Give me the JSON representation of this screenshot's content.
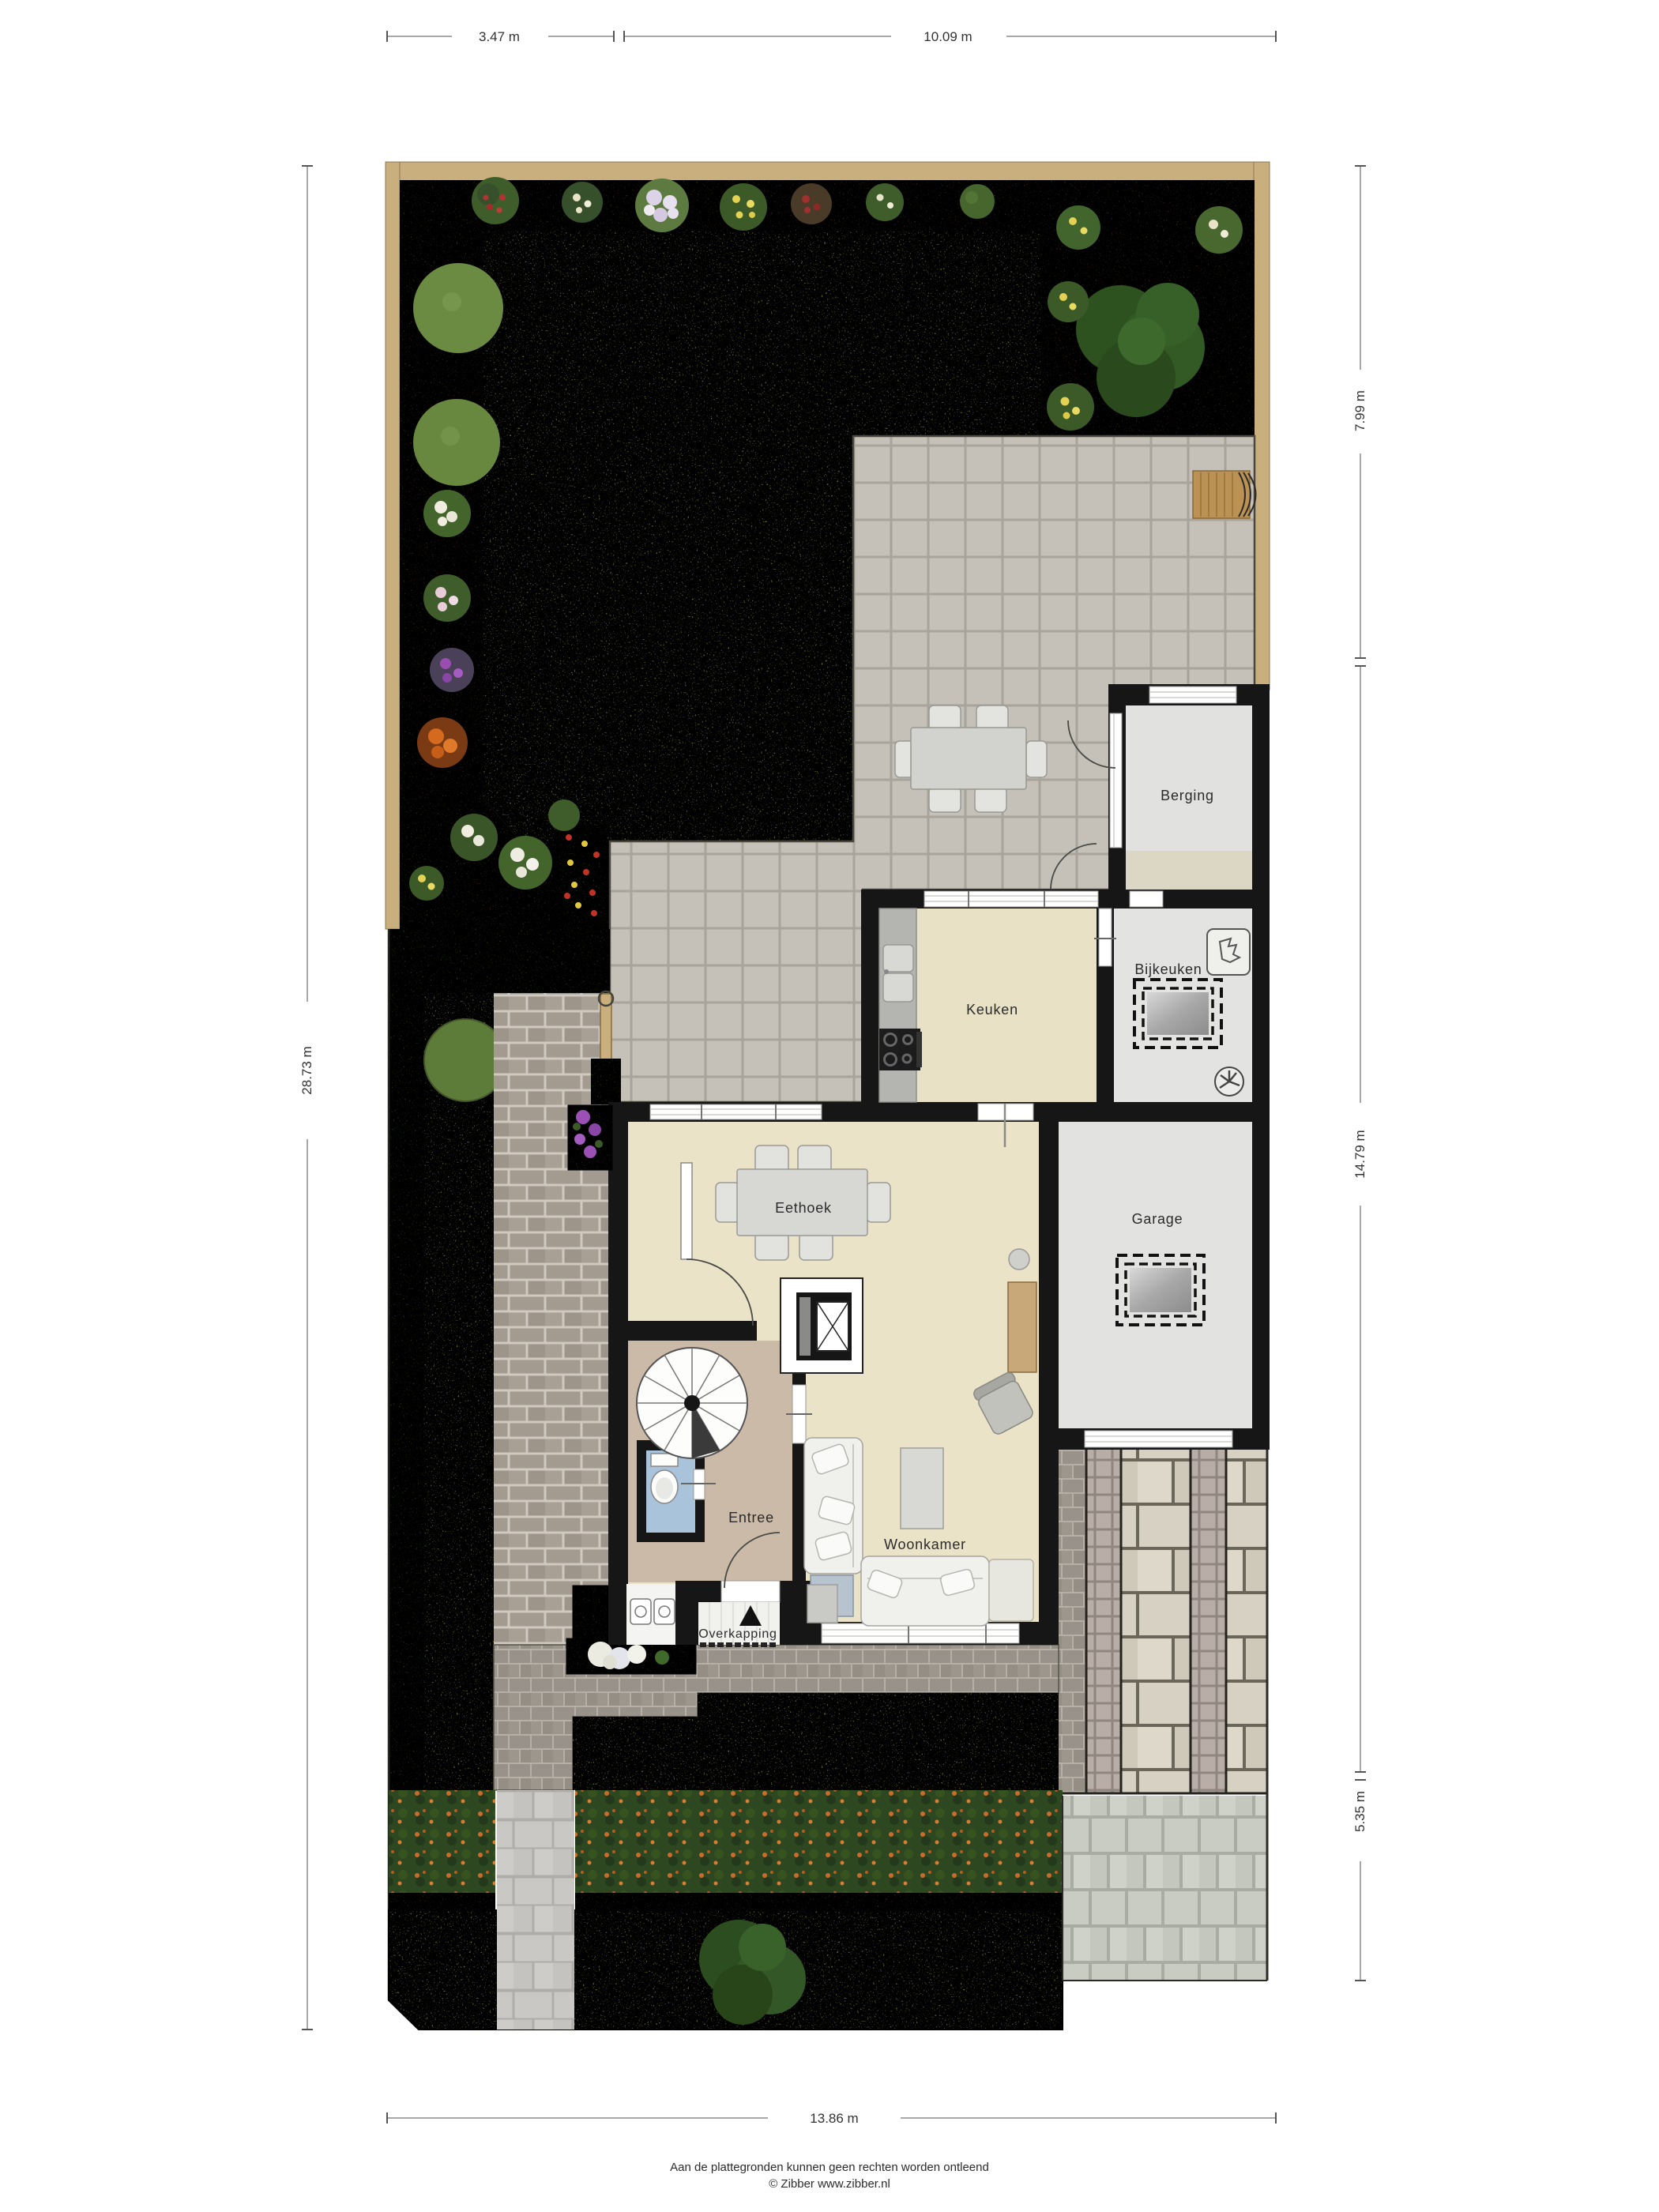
{
  "rooms": {
    "berging": "Berging",
    "bijkeuken": "Bijkeuken",
    "keuken": "Keuken",
    "eethoek": "Eethoek",
    "garage": "Garage",
    "entree": "Entree",
    "woonkamer": "Woonkamer",
    "overkapping": "Overkapping"
  },
  "dimensions": {
    "top_left": "3.47 m",
    "top_right": "10.09 m",
    "right_top": "7.99 m",
    "right_middle": "14.79 m",
    "right_bottom": "5.35 m",
    "left_side": "28.73 m",
    "bottom": "13.86 m"
  },
  "footer": {
    "disclaimer": "Aan de plattegronden kunnen geen rechten worden ontleend",
    "credit": "© Zibber www.zibber.nl"
  },
  "colors": {
    "wall": "#161616",
    "floor_living": "#eae3c8",
    "floor_entree": "#cbbaa7",
    "floor_garage": "#e3e3e1",
    "floor_toilet": "#a9c3db",
    "patio_tile": "#c5c1b8",
    "lawn": "#a3aa56",
    "soil": "#56402d",
    "hedge": "#3c5926",
    "fence_wood": "#c9ae7e",
    "driveway_slab": "#d6d1c3"
  }
}
